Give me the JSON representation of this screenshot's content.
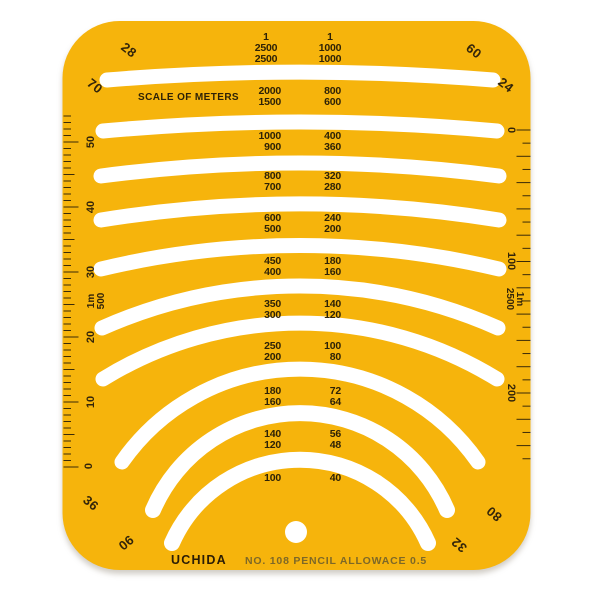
{
  "template": {
    "brand": "UCHIDA",
    "model_label": "NO. 108 PENCIL ALLOWACE 0.5",
    "title": "SCALE OF METERS",
    "colors": {
      "body": "#F6B40C",
      "cutout": "#FFFFFF",
      "ink": "#2E2206",
      "ruler_ink": "#3A2A08"
    }
  },
  "scale_headers": {
    "left": [
      "1",
      "2500",
      "2500"
    ],
    "right": [
      "1",
      "1000",
      "1000"
    ]
  },
  "rows": [
    {
      "l1": "2000",
      "l2": "1500",
      "r1": "800",
      "r2": "600"
    },
    {
      "l1": "1000",
      "l2": "900",
      "r1": "400",
      "r2": "360"
    },
    {
      "l1": "800",
      "l2": "700",
      "r1": "320",
      "r2": "280"
    },
    {
      "l1": "600",
      "l2": "500",
      "r1": "240",
      "r2": "200"
    },
    {
      "l1": "450",
      "l2": "400",
      "r1": "180",
      "r2": "160"
    },
    {
      "l1": "350",
      "l2": "300",
      "r1": "140",
      "r2": "120"
    },
    {
      "l1": "250",
      "l2": "200",
      "r1": "100",
      "r2": "80"
    },
    {
      "l1": "180",
      "l2": "160",
      "r1": "72",
      "r2": "64"
    },
    {
      "l1": "140",
      "l2": "120",
      "r1": "56",
      "r2": "48"
    },
    {
      "l1": "100",
      "l2": "",
      "r1": "40",
      "r2": ""
    }
  ],
  "corner_labels": {
    "top_left_outer": "28",
    "top_left_inner": "70",
    "top_right_outer": "60",
    "top_right_inner": "24",
    "bottom_left_inner": "36",
    "bottom_left_outer": "90",
    "bottom_right_inner": "80",
    "bottom_right_outer": "32"
  },
  "rulers": {
    "left": {
      "labels": [
        "50",
        "40",
        "30",
        "20",
        "10",
        "0"
      ],
      "ratio_lines": [
        "1m",
        "500"
      ]
    },
    "right": {
      "labels": [
        "0",
        "100",
        "200"
      ],
      "ratio_lines": [
        "1m",
        "2500"
      ]
    }
  }
}
